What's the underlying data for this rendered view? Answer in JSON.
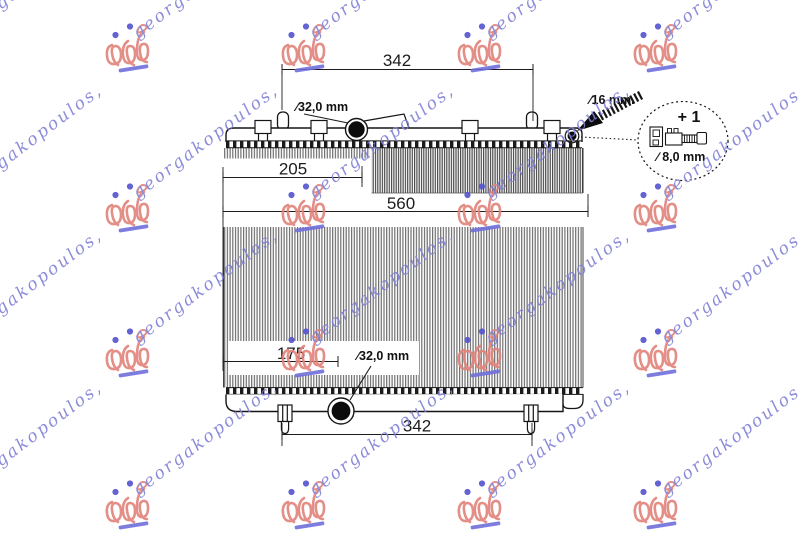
{
  "watermark": {
    "text": "georgakopoulos,",
    "text_color": "#8080d6",
    "logo_color": "#e0837b",
    "dot_color": "#5353cf",
    "underline_color": "#6f6fdb"
  },
  "drawing": {
    "dimensions": {
      "top_span": "342",
      "top_inlet_diameter": "∕32,0 mm",
      "inlet_offset": "205",
      "core_width": "560",
      "outlet_offset": "175",
      "bottom_outlet_diameter": "∕32,0 mm",
      "bottom_span": "342",
      "connector_diameter": "∕16 mm.",
      "extra_part_qty": "+ 1",
      "extra_part_diameter": "∕ 8,0 mm"
    }
  }
}
